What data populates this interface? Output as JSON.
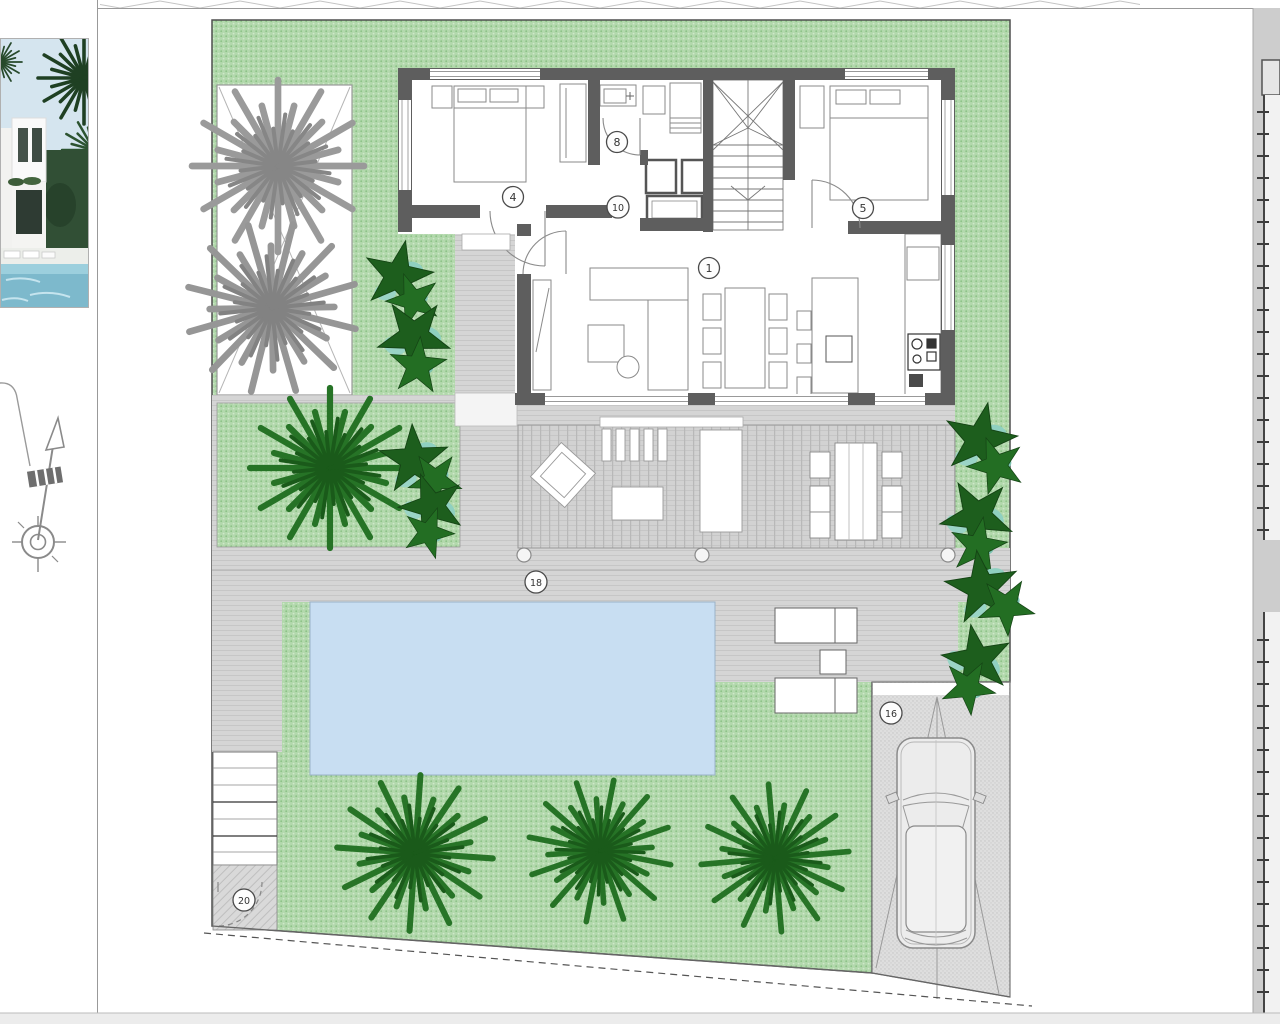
{
  "plan": {
    "area_labels": {
      "living_kitchen": "1",
      "bedroom_a": "4",
      "bedroom_b": "5",
      "bathroom": "8",
      "hallway": "10",
      "parking": "16",
      "terrace": "18",
      "entrance_steps": "20"
    },
    "colors": {
      "garden_green": "#b2d8ac",
      "garden_dot": "#8cc286",
      "hardscape_gray": "#d5d5d5",
      "deck_plank": "#b8b8b8",
      "wall_dark": "#5e5e5e",
      "pool_blue": "#c8def2",
      "parking_gray": "#dedede",
      "tree_green": "#267326",
      "tree_green_dark": "#1a5a1a",
      "tree_gray": "#9a9a9a",
      "bush_dark_green": "#1d5e1d",
      "bush_teal": "#8fd0c0",
      "page_white": "#ffffff"
    },
    "icons": {
      "north_arrow": "north-arrow-icon",
      "villa_photo": "villa-photo-thumbnail"
    }
  }
}
